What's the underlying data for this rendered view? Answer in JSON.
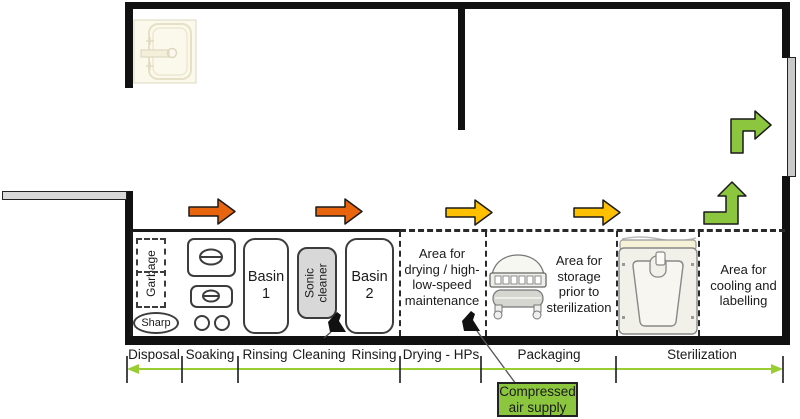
{
  "colors": {
    "flow_orange": "#e8650d",
    "flow_yellow": "#ffc000",
    "flow_green": "#8cc63e",
    "scale_green": "#9acd32",
    "air_box_bg": "#8cc63e"
  },
  "bench": {
    "garbage_label": "Garbage",
    "sharp_label": "Sharp",
    "basin1_label": "Basin\n1",
    "sonic_label": "Sonic\ncleaner",
    "basin2_label": "Basin\n2"
  },
  "areas": {
    "drying": "Area for\ndrying / high-\nlow-speed\nmaintenance",
    "storage": "Area for\nstorage\nprior to\nsterilization",
    "cooling": "Area for\ncooling and\nlabelling"
  },
  "annotations": {
    "compressed_air": "Compressed\nair supply"
  },
  "footer": {
    "zones": [
      "Disposal",
      "Soaking",
      "Rinsing",
      "Cleaning",
      "Rinsing",
      "Drying - HPs",
      "Packaging",
      "Sterilization"
    ]
  },
  "icons": {
    "sink": "sink-icon",
    "water_gun": "water-gun-icon",
    "air_gun": "air-gun-icon",
    "sealer": "pouch-sealer-icon",
    "sterilizer": "sterilizer-icon",
    "flow": "flow-arrow-icon"
  }
}
